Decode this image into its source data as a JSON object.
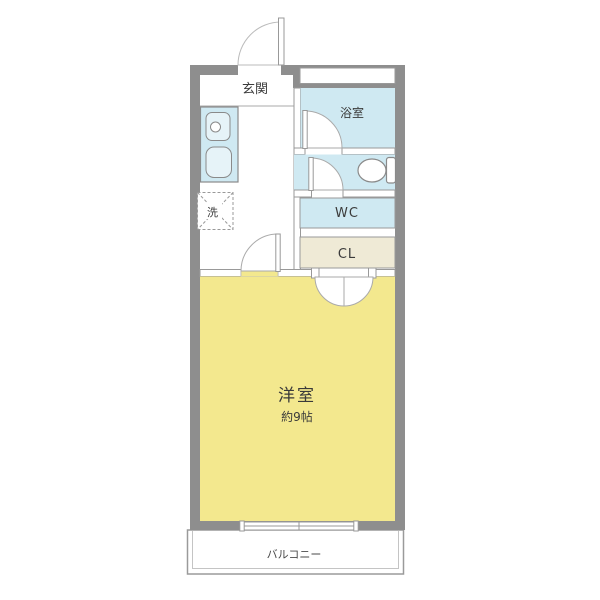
{
  "floorplan": {
    "rooms": {
      "entrance": {
        "label": "玄関"
      },
      "bathroom": {
        "label": "浴室"
      },
      "toilet": {
        "label": "WC"
      },
      "closet": {
        "label": "CL"
      },
      "laundry": {
        "label": "洗"
      },
      "living": {
        "label": "洋室",
        "size": "約9帖"
      },
      "balcony": {
        "label": "バルコニー"
      }
    },
    "icons": {
      "toilet": "toilet-icon",
      "stove": "stove-burner-icon",
      "sink": "kitchen-sink-icon",
      "laundry": "washing-machine-slot-icon"
    },
    "colors": {
      "wall": "#8e8e8e",
      "water": "#cfe9f2",
      "living": "#f3e88e",
      "closet": "#efead6",
      "fixture": "#e6f3f8",
      "outline": "#999999",
      "text": "#3a3a3a"
    }
  }
}
